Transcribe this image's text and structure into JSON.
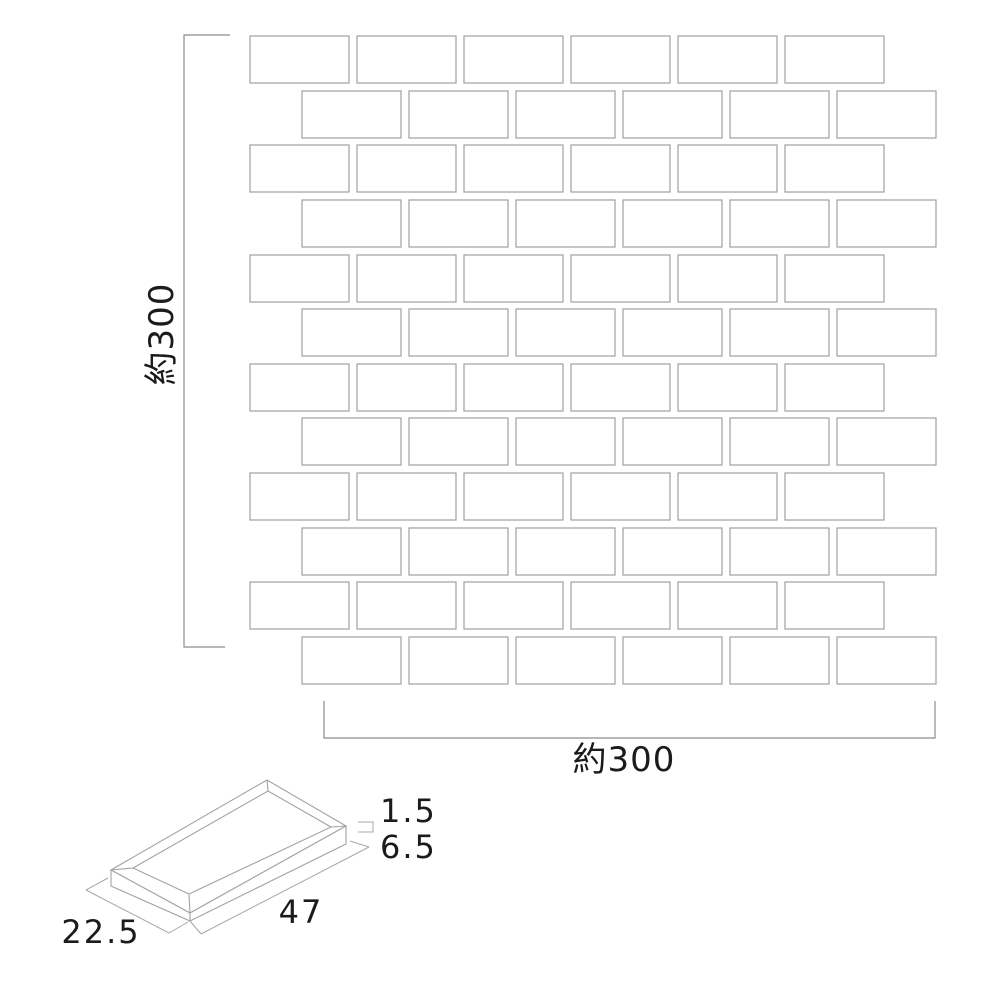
{
  "drawing": {
    "sheet": {
      "height_label": "約300",
      "width_label": "約300",
      "rows": 12,
      "columns": 6,
      "tile_count": 72,
      "pattern": "brick-offset"
    },
    "tile_detail": {
      "width_label": "22.5",
      "length_label": "47",
      "edge_thickness_label": "1.5",
      "thickness_label": "6.5"
    },
    "colors": {
      "tile_border": "#a0a0a0",
      "tile_fill": "#ffffff",
      "dimension_line": "#8c8c8c",
      "text": "#1b1b1b",
      "background": "#ffffff"
    }
  }
}
